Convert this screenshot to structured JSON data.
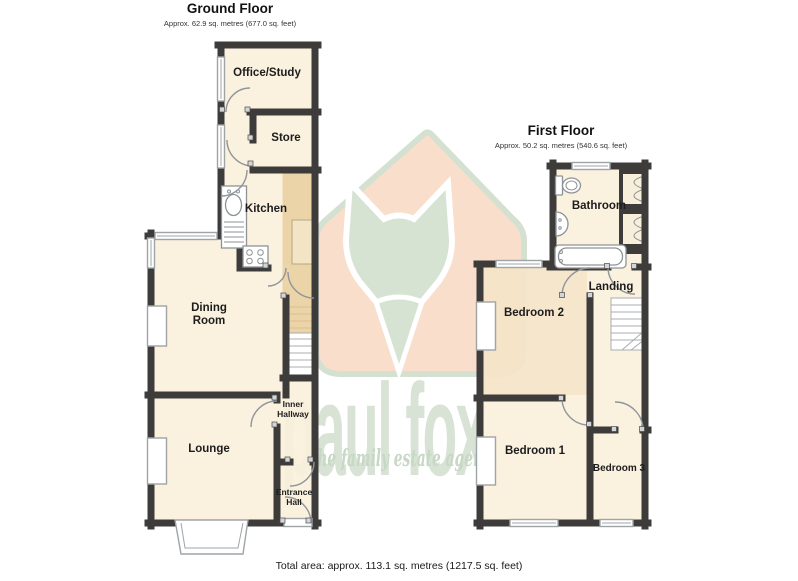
{
  "ground_floor": {
    "title": "Ground Floor",
    "area": "Approx. 62.9 sq. metres (677.0 sq. feet)",
    "rooms": {
      "office_study": "Office/Study",
      "store": "Store",
      "kitchen": "Kitchen",
      "dining_room_line1": "Dining",
      "dining_room_line2": "Room",
      "inner_hallway_line1": "Inner",
      "inner_hallway_line2": "Hallway",
      "lounge": "Lounge",
      "entrance_hall_line1": "Entrance",
      "entrance_hall_line2": "Hall"
    }
  },
  "first_floor": {
    "title": "First Floor",
    "area": "Approx. 50.2 sq. metres (540.6 sq. feet)",
    "rooms": {
      "bathroom": "Bathroom",
      "landing": "Landing",
      "bedroom2": "Bedroom 2",
      "bedroom1": "Bedroom 1",
      "bedroom3": "Bedroom 3"
    }
  },
  "footer": {
    "total_area": "Total area: approx. 113.1 sq. metres (1217.5 sq. feet)"
  },
  "watermark": {
    "brand": "paul fox",
    "tagline": "the family estate agents"
  },
  "icons": [
    "house-icon",
    "fox-head-icon",
    "stairs-icon",
    "toilet-icon",
    "sink-icon",
    "bathtub-icon",
    "stove-icon",
    "kitchen-sink-icon",
    "window",
    "door-arc",
    "bay-window",
    "chimney-breast",
    "front-door-threshold",
    "cupboard"
  ],
  "colors": {
    "wall": "#3d3c3b",
    "room_fill": "#f8efdb",
    "corridor_tan": "#ecd4a9",
    "bedroom2_tint": "#f3dcbc",
    "watermark_green": "#d8e3d5",
    "watermark_peach": "#f9decb",
    "tagline_green": "#c7d8c4"
  }
}
